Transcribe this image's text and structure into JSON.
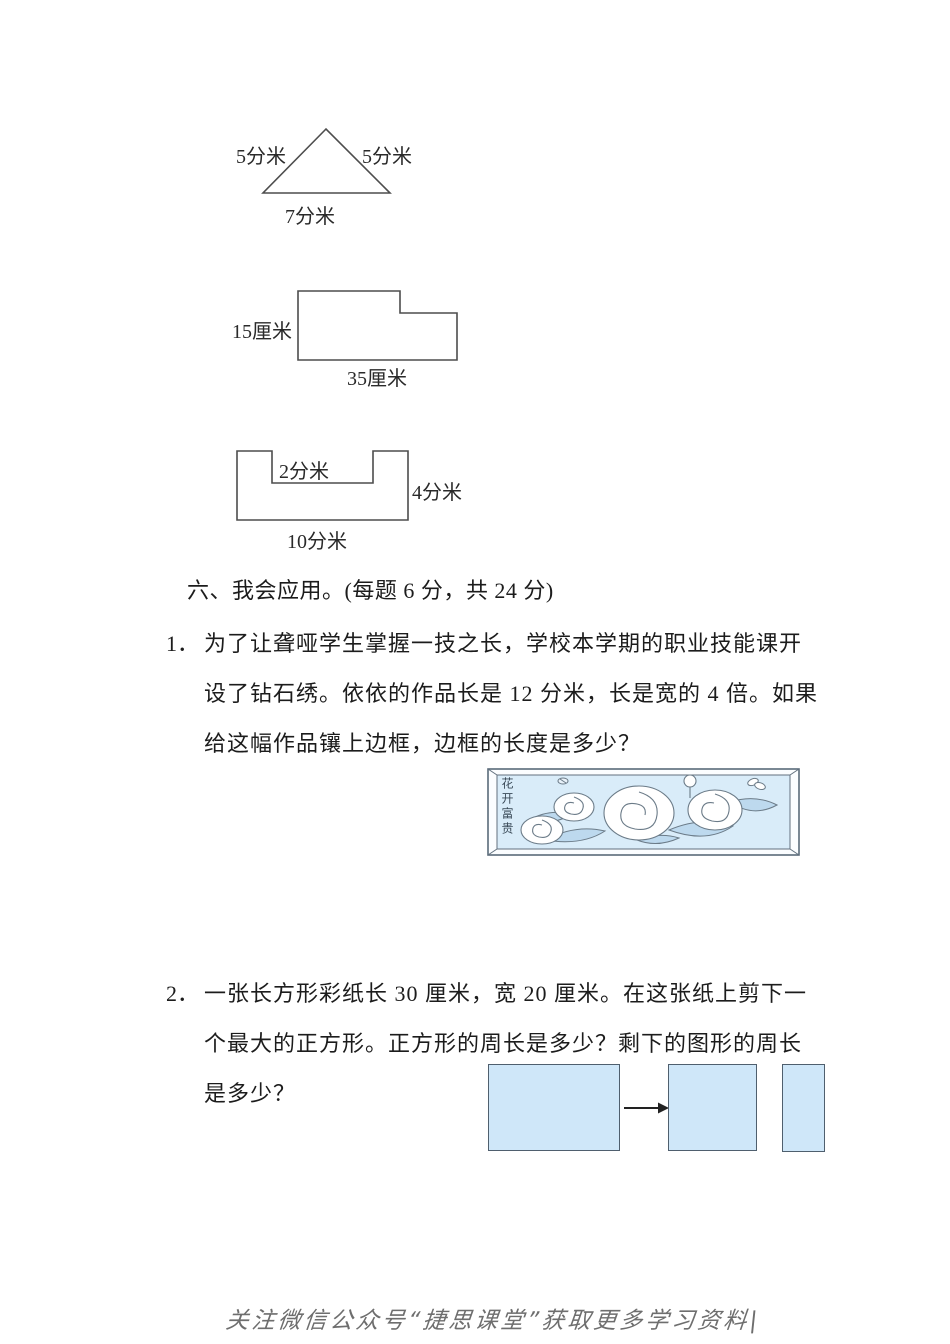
{
  "figures": {
    "triangle": {
      "left_label": "5分米",
      "right_label": "5分米",
      "bottom_label": "7分米"
    },
    "step_shape": {
      "left_label": "15厘米",
      "bottom_label": "35厘米"
    },
    "u_shape": {
      "notch_label": "2分米",
      "right_label": "4分米",
      "bottom_label": "10分米"
    }
  },
  "section6": {
    "heading": "六、我会应用。(每题 6 分，共 24 分)",
    "q1": {
      "number": "1．",
      "line1": "为了让聋哑学生掌握一技之长，学校本学期的职业技能课开",
      "line2": "设了钻石绣。依依的作品长是 12 分米，长是宽的 4 倍。如果",
      "line3": "给这幅作品镶上边框，边框的长度是多少？",
      "artwork_caption": "花开富贵"
    },
    "q2": {
      "number": "2．",
      "line1": "一张长方形彩纸长 30 厘米，宽 20 厘米。在这张纸上剪下一",
      "line2": "个最大的正方形。正方形的周长是多少？剩下的图形的周长",
      "line3": "是多少？"
    }
  },
  "watermark": {
    "text": "关注微信公众号“捷思课堂”获取更多学习资料|"
  },
  "colors": {
    "shape_outline": "#4d4d4d",
    "diagram_fill_blue": "#cfe7f9",
    "artwork_background": "#d9ecf9",
    "body_text": "#1c1c1c",
    "watermark_gray": "#6e6e6e"
  }
}
